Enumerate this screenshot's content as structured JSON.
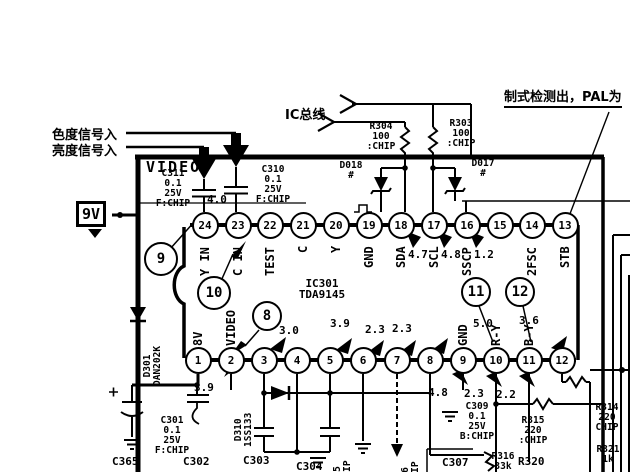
{
  "annotations": {
    "chroma_in": "色度信号入",
    "luma_in": "亮度信号入",
    "ic_bus": "IC总线",
    "standard_detect": "制式检测出，PAL为"
  },
  "power_rail": "9V",
  "shield_label": "VIDEO",
  "ic": {
    "ref": "IC301",
    "part": "TDA9145",
    "top_pins": [
      {
        "num": "24",
        "label": "Y IN",
        "value": ""
      },
      {
        "num": "23",
        "label": "C IN",
        "value": ""
      },
      {
        "num": "22",
        "label": "TEST",
        "value": ""
      },
      {
        "num": "21",
        "label": "C",
        "value": ""
      },
      {
        "num": "20",
        "label": "Y",
        "value": ""
      },
      {
        "num": "19",
        "label": "GND",
        "value": ""
      },
      {
        "num": "18",
        "label": "SDA",
        "value": "4.7"
      },
      {
        "num": "17",
        "label": "SCL",
        "value": "4.8"
      },
      {
        "num": "16",
        "label": "SSCP",
        "value": "1.2"
      },
      {
        "num": "15",
        "label": "",
        "value": ""
      },
      {
        "num": "14",
        "label": "2FSC",
        "value": ""
      },
      {
        "num": "13",
        "label": "STB",
        "value": ""
      }
    ],
    "bottom_pins": [
      {
        "num": "1",
        "label": "8V",
        "value": ""
      },
      {
        "num": "2",
        "label": "VIDEO",
        "value": ""
      },
      {
        "num": "3",
        "label": "",
        "value": ""
      },
      {
        "num": "4",
        "label": "",
        "value": ""
      },
      {
        "num": "5",
        "label": "",
        "value": ""
      },
      {
        "num": "6",
        "label": "",
        "value": ""
      },
      {
        "num": "7",
        "label": "",
        "value": ""
      },
      {
        "num": "8",
        "label": "",
        "value": ""
      },
      {
        "num": "9",
        "label": "GND",
        "value": ""
      },
      {
        "num": "10",
        "label": "R-Y",
        "value": ""
      },
      {
        "num": "11",
        "label": "B-Y",
        "value": ""
      },
      {
        "num": "12",
        "label": "",
        "value": ""
      }
    ]
  },
  "callouts": [
    "9",
    "10",
    "8",
    "11",
    "12"
  ],
  "voltages": {
    "pin23_ac": "4.0",
    "rail": "3.9",
    "row": [
      "3.0",
      "3.9",
      "2.3",
      "2.3",
      "5.0",
      "3.6"
    ],
    "below": [
      "4.8",
      "2.3",
      "2.2"
    ]
  },
  "components": {
    "c311": "C311\n0.1\n25V\nF:CHIP",
    "c310": "C310\n0.1\n25V\nF:CHIP",
    "r304": "R304\n100\n:CHIP",
    "r303": "R303\n100\n:CHIP",
    "d018": "D018\n#",
    "d017": "D017\n#",
    "d301": "D301\nDAN202K",
    "d310": "D310\n1SS133",
    "c301": "C301\n0.1\n25V\nF:CHIP",
    "c365": "C365",
    "c302": "C302",
    "c303": "C303",
    "c304": "C304",
    "c305": "305\n:CHIP",
    "c306": "306\n:CHIP",
    "c307": "C307",
    "c309": "C309\n0.1\n25V\nB:CHIP",
    "r315": "R315\n220\n:CHIP",
    "r314": "R314\n220\nCHIP",
    "r316": "R316\n33k",
    "r320": "R320",
    "r321": "R321\n1k"
  }
}
